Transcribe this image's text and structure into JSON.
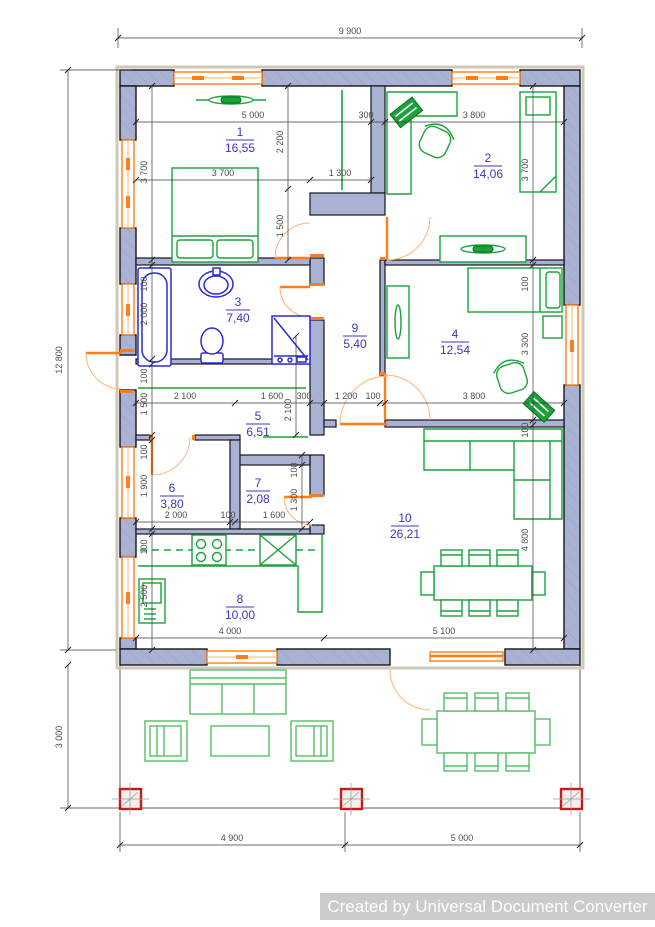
{
  "watermark": "Created by Universal Document Converter",
  "colors": {
    "wall_fill": "#a9b2d2",
    "window_orange": "#ff7d1a",
    "furniture_green": "#1ba23a",
    "terrace_green": "#57bd68",
    "sanitary_blue": "#2b2bd4",
    "label_blue": "#3838c2",
    "column_red": "#c21d1d",
    "dimension_gray": "#4c4c4c"
  },
  "rooms": [
    {
      "number": "1",
      "area": "16,55"
    },
    {
      "number": "2",
      "area": "14,06"
    },
    {
      "number": "3",
      "area": "7,40"
    },
    {
      "number": "4",
      "area": "12,54"
    },
    {
      "number": "5",
      "area": "6,51"
    },
    {
      "number": "6",
      "area": "3,80"
    },
    {
      "number": "7",
      "area": "2,08"
    },
    {
      "number": "8",
      "area": "10,00"
    },
    {
      "number": "9",
      "area": "5,40"
    },
    {
      "number": "10",
      "area": "26,21"
    }
  ],
  "dims": {
    "overall_width": "9 900",
    "overall_height": "12 800",
    "terrace_height": "3 000",
    "terrace_left": "4 900",
    "terrace_right": "5 000",
    "top_room1": "5 000",
    "top_wall": "300",
    "top_room2": "3 800",
    "room1_left": "3 700",
    "room1_upper": "2 200",
    "room1_bed": "3 700",
    "nook": "1 300",
    "room1_lower": "1 500",
    "room2_right": "3 700",
    "bath_wall_top": "100",
    "bath": "2 000",
    "bath_wall_bottom": "100",
    "hall5": "1 500",
    "row_hall_a": "2 100",
    "row_hall_b": "1 600",
    "row_hall_c": "300",
    "row_hall_d": "1 200",
    "row_hall_e": "100",
    "corridor": "2 100",
    "room4_wall_top": "100",
    "room4_right": "3 300",
    "room4_wall_bottom": "100",
    "room4_width": "3 800",
    "room6_wall": "100",
    "room6": "1 900",
    "room7_wall": "100",
    "room7": "1 300",
    "row_d_a": "2 000",
    "row_d_b": "100",
    "row_d_c": "1 600",
    "kitchen_wall": "100",
    "kitchen": "2 500",
    "kitchen_width": "4 000",
    "living_width": "5 100",
    "living": "4 800"
  }
}
